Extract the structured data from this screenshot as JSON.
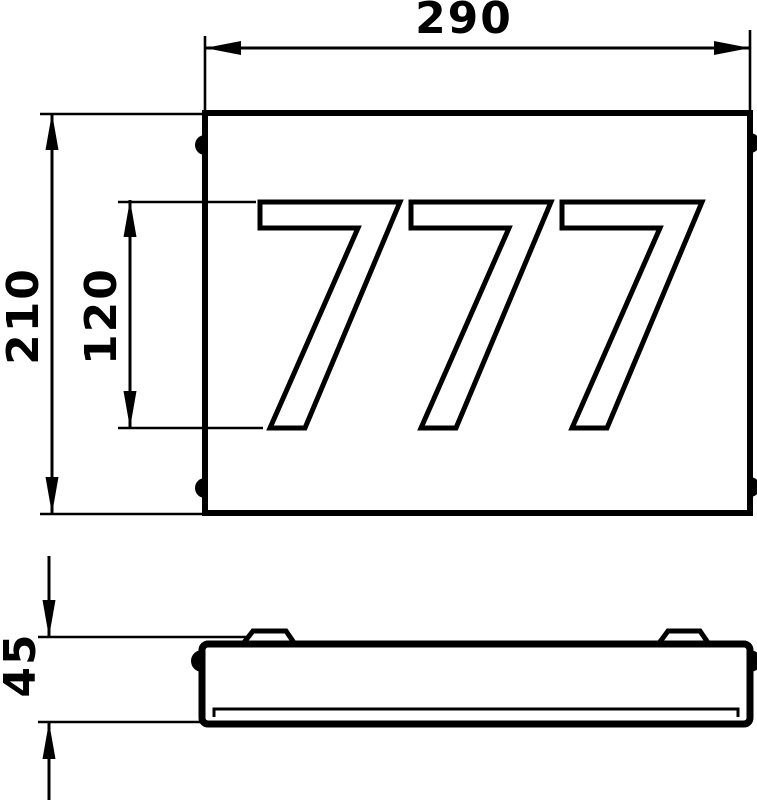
{
  "drawing": {
    "house_number": "777",
    "dimensions": {
      "width": "290",
      "height": "210",
      "digit_height": "120",
      "depth": "45"
    }
  }
}
